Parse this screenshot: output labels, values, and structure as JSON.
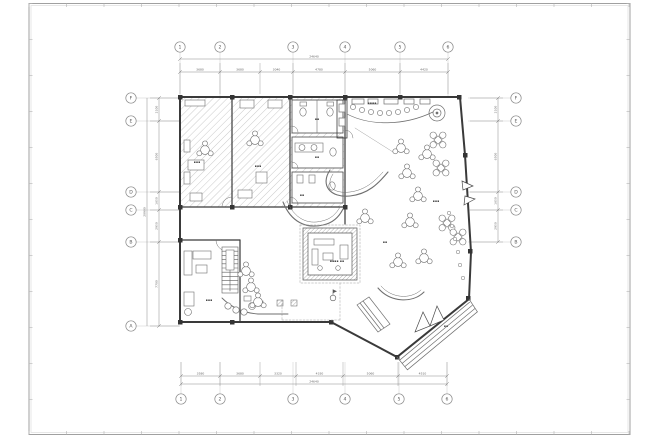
{
  "sheet": {
    "title": "floor-plan-drawing",
    "background": "#ffffff",
    "frame_color": "#a8a8a8",
    "grid_color": "#c9c9c9",
    "wall_color": "#3a3a3a",
    "thin_color": "#6f6f6f",
    "dim_color": "#8a8a8a"
  },
  "grid": {
    "top": {
      "y": 47,
      "x": [
        180,
        220,
        293,
        345,
        400,
        448
      ],
      "labels": [
        "1",
        "2",
        "3",
        "4",
        "5",
        "6"
      ]
    },
    "bottom": {
      "y": 399,
      "x": [
        181,
        220,
        293,
        345,
        399,
        447
      ],
      "labels": [
        "1",
        "2",
        "3",
        "4",
        "5",
        "6"
      ]
    },
    "left": {
      "x": 131,
      "y": [
        98,
        121,
        192,
        210,
        242,
        326
      ],
      "labels": [
        "F",
        "E",
        "D",
        "C",
        "B",
        "A"
      ]
    },
    "right": {
      "x": 516,
      "y": [
        98,
        121,
        192,
        210,
        242
      ],
      "labels": [
        "F",
        "E",
        "D",
        "C",
        "B"
      ]
    }
  },
  "dimensions": {
    "top": {
      "bounds": [
        180,
        220,
        260,
        293,
        345,
        400,
        448
      ],
      "labels": [
        "3680",
        "3680",
        "3040",
        "4780",
        "5060",
        "4420"
      ],
      "total": "24640"
    },
    "bottom": {
      "bounds": [
        181,
        220,
        260,
        296,
        343,
        398,
        447
      ],
      "labels": [
        "3580",
        "3680",
        "3320",
        "4330",
        "5060",
        "4510"
      ],
      "total": "24640"
    },
    "left": {
      "bounds": [
        98,
        121,
        192,
        210,
        242,
        326
      ],
      "labels": [
        "2100",
        "6500",
        "1650",
        "2950",
        "7700"
      ],
      "total": "20900"
    },
    "right": {
      "bounds": [
        98,
        121,
        192,
        210,
        242
      ],
      "labels": [
        "2100",
        "6500",
        "1650",
        "2950"
      ],
      "total": ""
    }
  },
  "room_labels": [
    {
      "x": 197,
      "y": 163,
      "t": "▪▪▪"
    },
    {
      "x": 258,
      "y": 167,
      "t": "▪▪▪"
    },
    {
      "x": 317,
      "y": 120,
      "t": "▪▪"
    },
    {
      "x": 317,
      "y": 158,
      "t": "▪▪"
    },
    {
      "x": 372,
      "y": 104,
      "t": "▪▪▪▪"
    },
    {
      "x": 436,
      "y": 202,
      "t": "▪▪▪"
    },
    {
      "x": 337,
      "y": 262,
      "t": "▪▪▪▪ ▪▪"
    },
    {
      "x": 209,
      "y": 301,
      "t": "▪▪▪"
    },
    {
      "x": 446,
      "y": 327,
      "t": "▪▪"
    },
    {
      "x": 302,
      "y": 196,
      "t": "▪▪"
    },
    {
      "x": 385,
      "y": 243,
      "t": "▪▪"
    }
  ],
  "furniture": {
    "round_tables": [
      [
        401,
        148
      ],
      [
        427,
        154
      ],
      [
        407,
        173
      ],
      [
        418,
        196
      ],
      [
        365,
        218
      ],
      [
        410,
        222
      ],
      [
        424,
        258
      ],
      [
        398,
        262
      ],
      [
        246,
        271
      ],
      [
        251,
        287
      ],
      [
        258,
        302
      ],
      [
        205,
        150
      ],
      [
        255,
        140
      ]
    ],
    "x_tables": [
      [
        438,
        140
      ],
      [
        441,
        168
      ],
      [
        447,
        223
      ],
      [
        458,
        237
      ]
    ],
    "bar_stools_top": [
      [
        353,
        107
      ],
      [
        362,
        110
      ],
      [
        371,
        112
      ],
      [
        380,
        113
      ],
      [
        389,
        113
      ],
      [
        398,
        112
      ],
      [
        407,
        110
      ],
      [
        416,
        107
      ]
    ],
    "bar_stools_bottom": [
      [
        228,
        306
      ],
      [
        236,
        310
      ],
      [
        244,
        312
      ]
    ],
    "wall_chairs": [
      [
        449,
        213
      ],
      [
        452,
        226
      ],
      [
        455,
        239
      ],
      [
        458,
        252
      ],
      [
        460,
        265
      ],
      [
        463,
        278
      ]
    ]
  },
  "symbols": {
    "level_marker": {
      "x": 333,
      "y": 298
    }
  }
}
